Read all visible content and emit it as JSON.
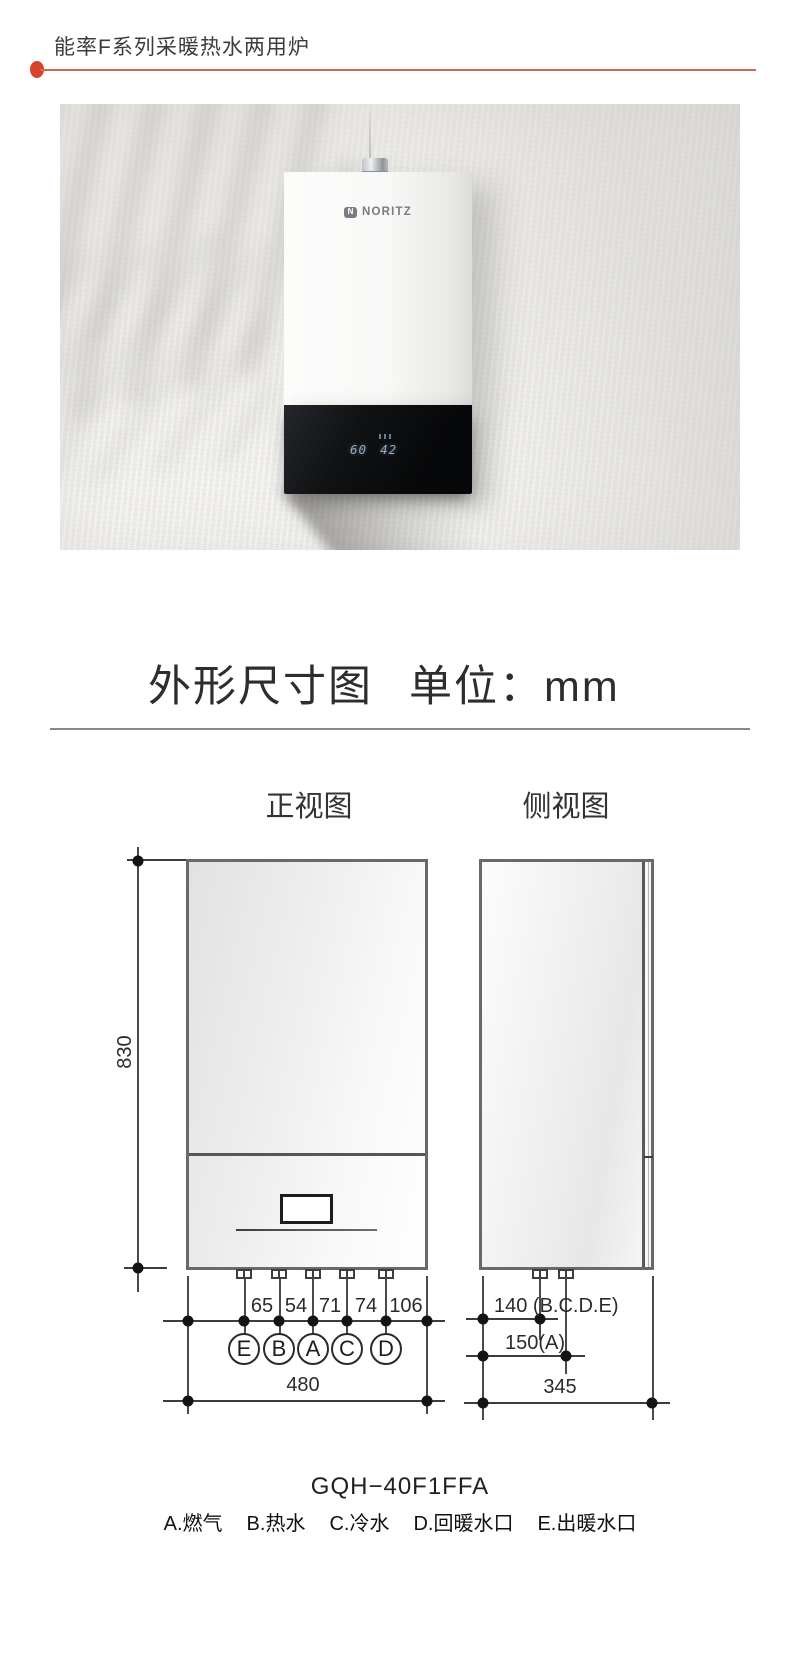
{
  "header": {
    "title": "能率F系列采暖热水两用炉"
  },
  "photo": {
    "brand_mark": "N",
    "brand": "NORITZ",
    "display": {
      "heating_temp": "60",
      "hot_water_temp": "42"
    }
  },
  "section": {
    "title": "外形尺寸图",
    "unit": "单位：mm"
  },
  "views": {
    "front": "正视图",
    "side": "侧视图"
  },
  "dims": {
    "height": "830",
    "width": "480",
    "spacings": [
      "65",
      "54",
      "71",
      "74",
      "106"
    ],
    "ports": [
      "E",
      "B",
      "A",
      "C",
      "D"
    ],
    "side_offset_bcde": "140 (B.C.D.E)",
    "side_offset_a": "150(A)",
    "depth": "345"
  },
  "model": "GQH−40F1FFA",
  "legend": [
    "A.燃气",
    "B.热水",
    "C.冷水",
    "D.回暖水口",
    "E.出暖水口"
  ],
  "colors": {
    "accent": "#d7432a",
    "accent_line": "#cf6850",
    "drawing_border": "#696969"
  }
}
